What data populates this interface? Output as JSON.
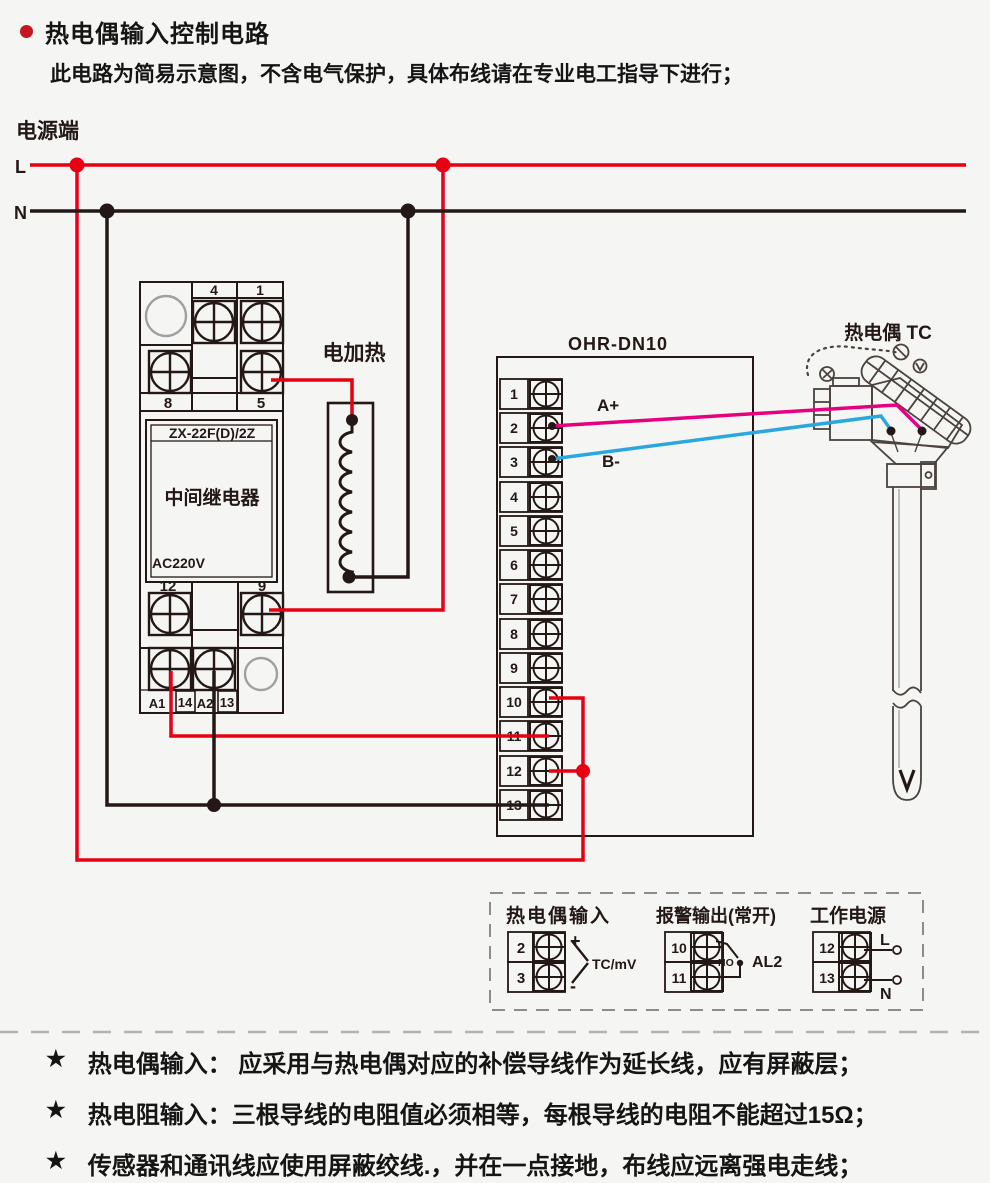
{
  "header": {
    "title": "热电偶输入控制电路",
    "subtitle": "此电路为简易示意图，不含电气保护，具体布线请在专业电工指导下进行；"
  },
  "power": {
    "label": "电源端",
    "l": "L",
    "n": "N"
  },
  "relay": {
    "model": "ZX-22F(D)/2Z",
    "name": "中间继电器",
    "voltage": "AC220V",
    "t4": "4",
    "t1": "1",
    "t8": "8",
    "t5": "5",
    "t12": "12",
    "t9": "9",
    "a1": "A1",
    "t14": "14",
    "a2": "A2",
    "t13": "13"
  },
  "heater": {
    "label": "电加热"
  },
  "controller": {
    "model": "OHR-DN10",
    "terminals": [
      "1",
      "2",
      "3",
      "4",
      "5",
      "6",
      "7",
      "8",
      "9",
      "10",
      "11",
      "12",
      "13"
    ],
    "wire_a": "A+",
    "wire_b": "B-"
  },
  "thermocouple": {
    "label": "热电偶 TC"
  },
  "legend": {
    "tc_input": {
      "title": "热电偶输入",
      "t2": "2",
      "t3": "3",
      "plus": "+",
      "minus": "-",
      "signal": "TC/mV"
    },
    "alarm": {
      "title": "报警输出(常开)",
      "t10": "10",
      "t11": "11",
      "no": "NO",
      "name": "AL2"
    },
    "supply": {
      "title": "工作电源",
      "t12": "12",
      "t13": "13",
      "l": "L",
      "n": "N"
    }
  },
  "notes": {
    "star": "★",
    "items": [
      "热电偶输入： 应采用与热电偶对应的补偿导线作为延长线，应有屏蔽层；",
      "热电阻输入：三根导线的电阻值必须相等，每根导线的电阻不能超过15Ω；",
      "传感器和通讯线应使用屏蔽绞线.，并在一点接地，布线应远离强电走线；"
    ]
  },
  "colors": {
    "red": "#e60012",
    "black": "#231815",
    "magenta": "#e6007e",
    "blue": "#2ba7df",
    "gray": "#9fa0a0"
  }
}
